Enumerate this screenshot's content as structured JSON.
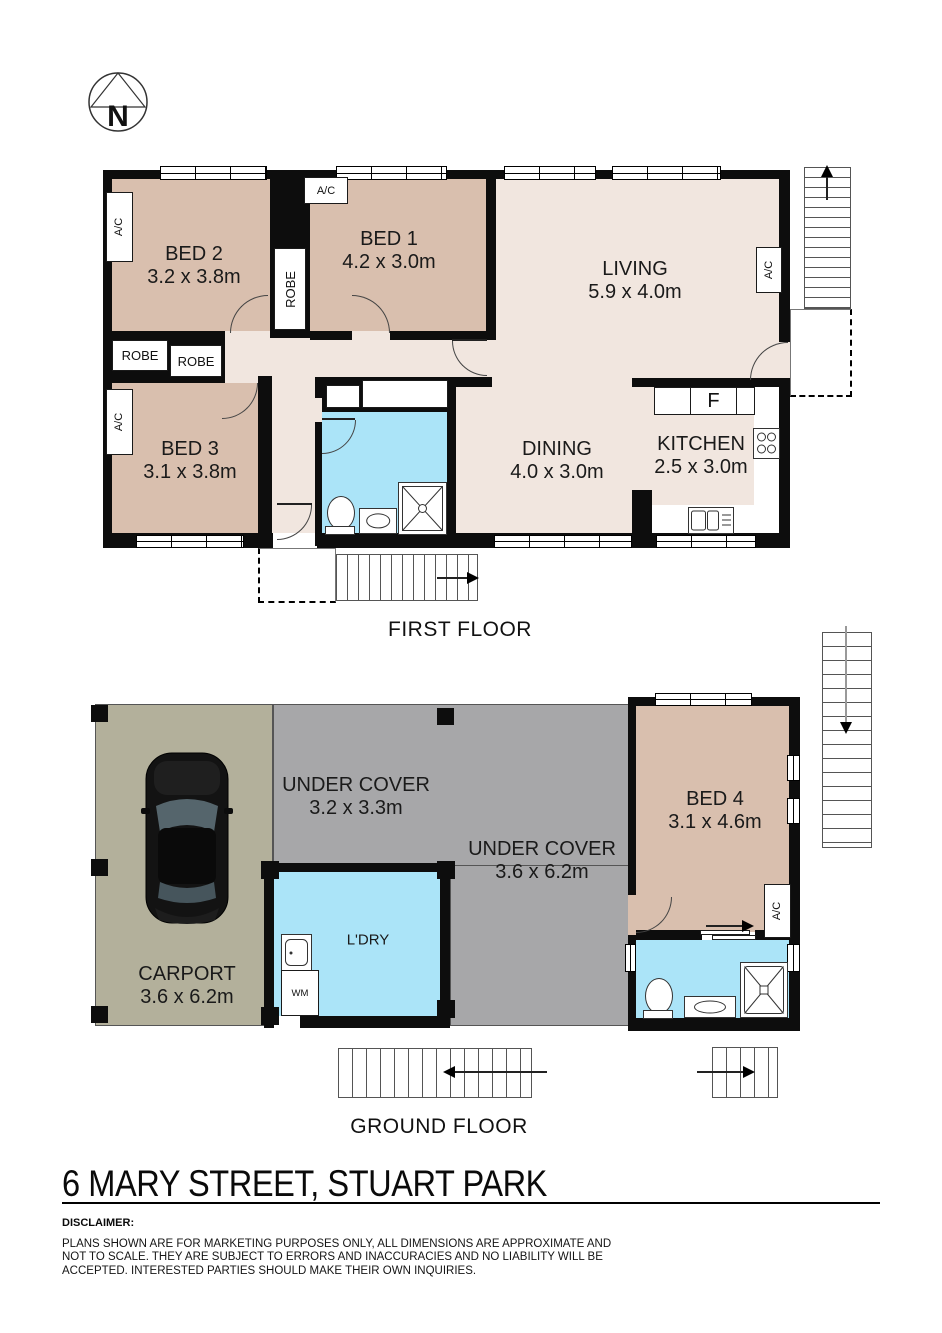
{
  "page": {
    "title": "6 MARY STREET, STUART PARK"
  },
  "compass": {
    "n": "N"
  },
  "labels": {
    "ac": "A/C",
    "robe": "ROBE",
    "fridge": "F",
    "wm": "WM",
    "ldry": "L'DRY",
    "first_floor": "FIRST FLOOR",
    "ground_floor": "GROUND FLOOR"
  },
  "rooms": {
    "bed1": {
      "name": "BED 1",
      "dims": "4.2 x 3.0m"
    },
    "bed2": {
      "name": "BED 2",
      "dims": "3.2 x 3.8m"
    },
    "bed3": {
      "name": "BED 3",
      "dims": "3.1 x 3.8m"
    },
    "bed4": {
      "name": "BED 4",
      "dims": "3.1 x 4.6m"
    },
    "living": {
      "name": "LIVING",
      "dims": "5.9 x 4.0m"
    },
    "dining": {
      "name": "DINING",
      "dims": "4.0 x 3.0m"
    },
    "kitchen": {
      "name": "KITCHEN",
      "dims": "2.5 x 3.0m"
    },
    "carport": {
      "name": "CARPORT",
      "dims": "3.6 x 6.2m"
    },
    "under_cover_1": {
      "name": "UNDER COVER",
      "dims": "3.2 x 3.3m"
    },
    "under_cover_2": {
      "name": "UNDER COVER",
      "dims": "3.6 x 6.2m"
    }
  },
  "disclaimer": {
    "heading": "DISCLAIMER:",
    "lines": [
      "PLANS SHOWN ARE FOR MARKETING PURPOSES ONLY, ALL DIMENSIONS ARE APPROXIMATE AND",
      "NOT TO SCALE. THEY ARE SUBJECT TO ERRORS AND INACCURACIES AND NO LIABILITY WILL BE",
      "ACCEPTED. INTERESTED PARTIES SHOULD MAKE THEIR OWN INQUIRIES."
    ]
  },
  "colors": {
    "bedroom_fill": "#d9bfae",
    "living_fill": "#f1e6df",
    "wet_area_fill": "#abe4f8",
    "carport_fill": "#b3b09b",
    "under_cover_fill": "#a7a7a9",
    "wall": "#0d0d0d"
  }
}
